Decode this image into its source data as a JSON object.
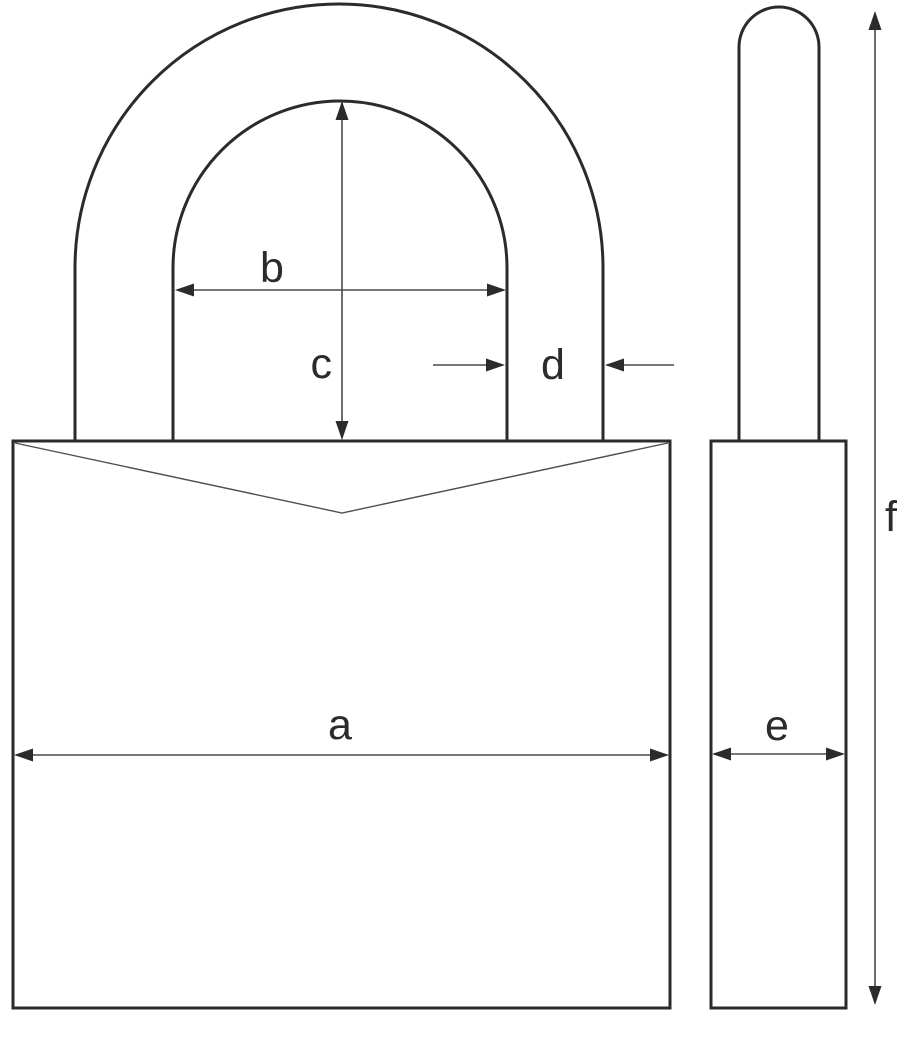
{
  "diagram": {
    "subject": "padlock-dimension-diagram",
    "views": {
      "front": "padlock-front-view",
      "side": "padlock-side-view"
    },
    "labels": {
      "a": "a",
      "b": "b",
      "c": "c",
      "d": "d",
      "e": "e",
      "f": "f"
    },
    "colors": {
      "background": "#ffffff",
      "outline": "#2b2b2b",
      "dimension_line": "#4a4a4a",
      "label_text": "#2b2b2b"
    }
  }
}
